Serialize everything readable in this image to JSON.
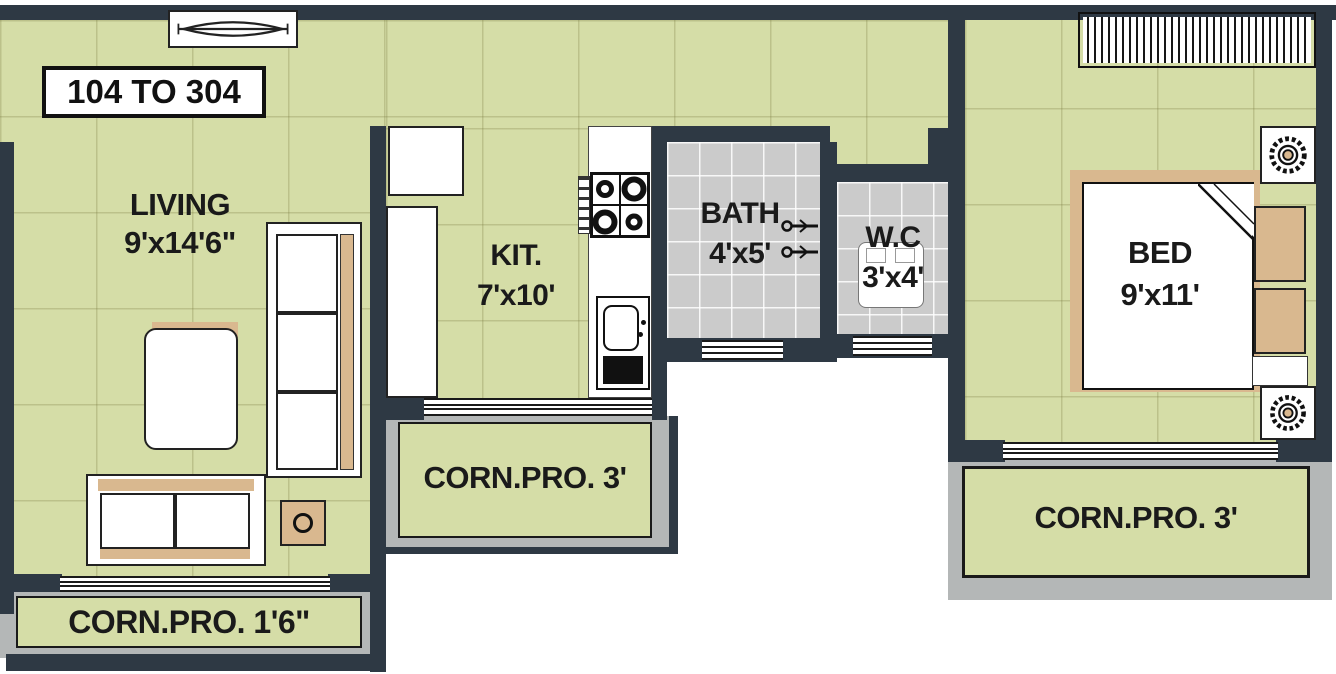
{
  "unit_label": "104 TO 304",
  "rooms": {
    "living": {
      "name": "LIVING",
      "dims": "9'x14'6\""
    },
    "kitchen": {
      "name": "KIT.",
      "dims": "7'x10'"
    },
    "bath": {
      "name": "BATH",
      "dims": "4'x5'"
    },
    "wc": {
      "name": "W.C",
      "dims": "3'x4'"
    },
    "bed": {
      "name": "BED",
      "dims": "9'x11'"
    }
  },
  "balconies": {
    "living": "CORN.PRO. 1'6\"",
    "kitchen": "CORN.PRO. 3'",
    "bedroom": "CORN.PRO. 3'"
  },
  "colors": {
    "wall": "#2e3944",
    "floor": "#d5dda7",
    "tile": "#cbcbcb",
    "balcony": "#b4b7b7",
    "wood": "#d9b88f",
    "ink": "#1a1a1a"
  }
}
